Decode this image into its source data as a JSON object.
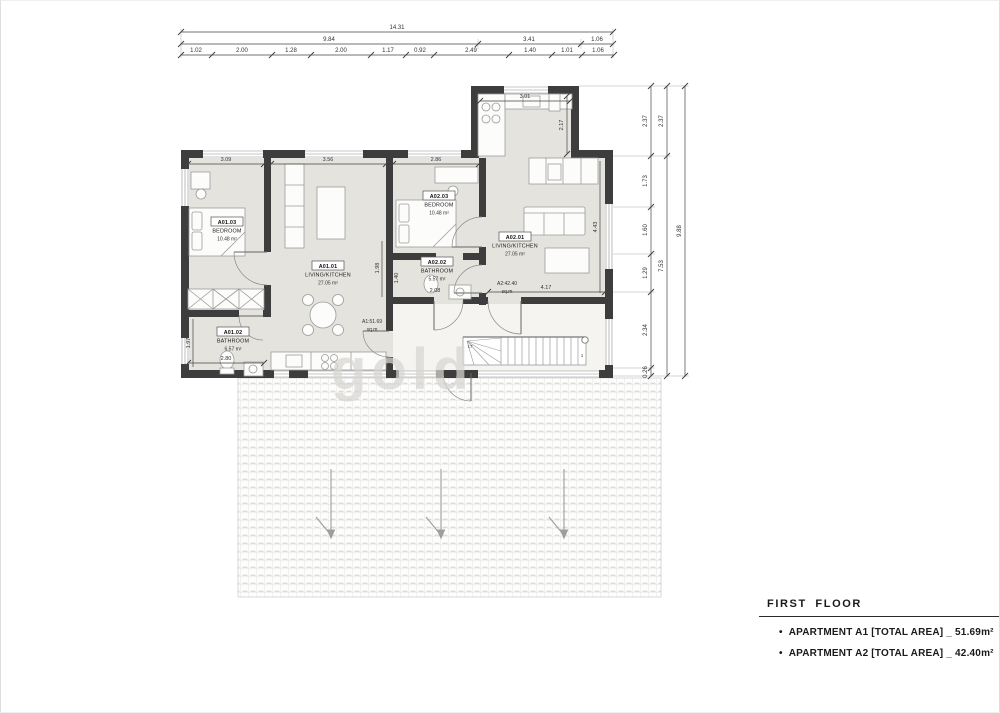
{
  "legend": {
    "title": "FIRST FLOOR",
    "bullet": "•",
    "items": [
      {
        "label": "APARTMENT A1 [TOTAL AREA] _ 51.69m²"
      },
      {
        "label": "APARTMENT A2 [TOTAL AREA] _ 42.40m²"
      }
    ]
  },
  "watermark": "gold",
  "rooms": {
    "a1_bedroom": {
      "code": "A01.03",
      "name": "BEDROOM",
      "area": "10.48 m²"
    },
    "a1_living": {
      "code": "A01.01",
      "name": "LIVING/KITCHEN",
      "area": "27.05 m²"
    },
    "a1_bathroom": {
      "code": "A01.02",
      "name": "BATHROOM",
      "area": "6.57 m²"
    },
    "a2_bedroom": {
      "code": "A02.03",
      "name": "BEDROOM",
      "area": "10.48 m²"
    },
    "a2_bathroom": {
      "code": "A02.02",
      "name": "BATHROOM",
      "area": "5.57 m²"
    },
    "a2_living": {
      "code": "A02.01",
      "name": "LIVING/KITCHEN",
      "area": "27.05 m²"
    }
  },
  "totals": {
    "a1": {
      "value": "A1:51.69",
      "unit": "sq.m"
    },
    "a2": {
      "value": "A2:42.40",
      "unit": "sq.m"
    }
  },
  "stairs": {
    "top_step": "17",
    "bottom_step": "1"
  },
  "dimensions": {
    "top_total": "14.31",
    "top_mid": [
      "9.84",
      "3.41",
      "1.06"
    ],
    "top_detail": [
      "1.02",
      "2.00",
      "1.28",
      "2.00",
      "1.17",
      "0.92",
      "2.49",
      "1.40",
      "1.01",
      "1.06"
    ],
    "right_inner": [
      "2.37",
      "1.73",
      "1.60",
      "1.29",
      "2.34",
      "0.26"
    ],
    "right_mid": [
      "2.37",
      "7.53"
    ],
    "right_total": "9.88",
    "interior": {
      "a1_bedroom_w": "3.09",
      "a1_living_w": "3.56",
      "a2_bedroom_w": "2.86",
      "kitchen_w": "3.01",
      "kitchen_h": "2.17",
      "a1_bath_w": "2.80",
      "a1_bath_h": "1.97",
      "a2_bath_w": "2.08",
      "a2_bath_h": "1.40",
      "corridor_w": "4.17",
      "a2_living_h": "4.43",
      "party_h": "1.98"
    }
  }
}
